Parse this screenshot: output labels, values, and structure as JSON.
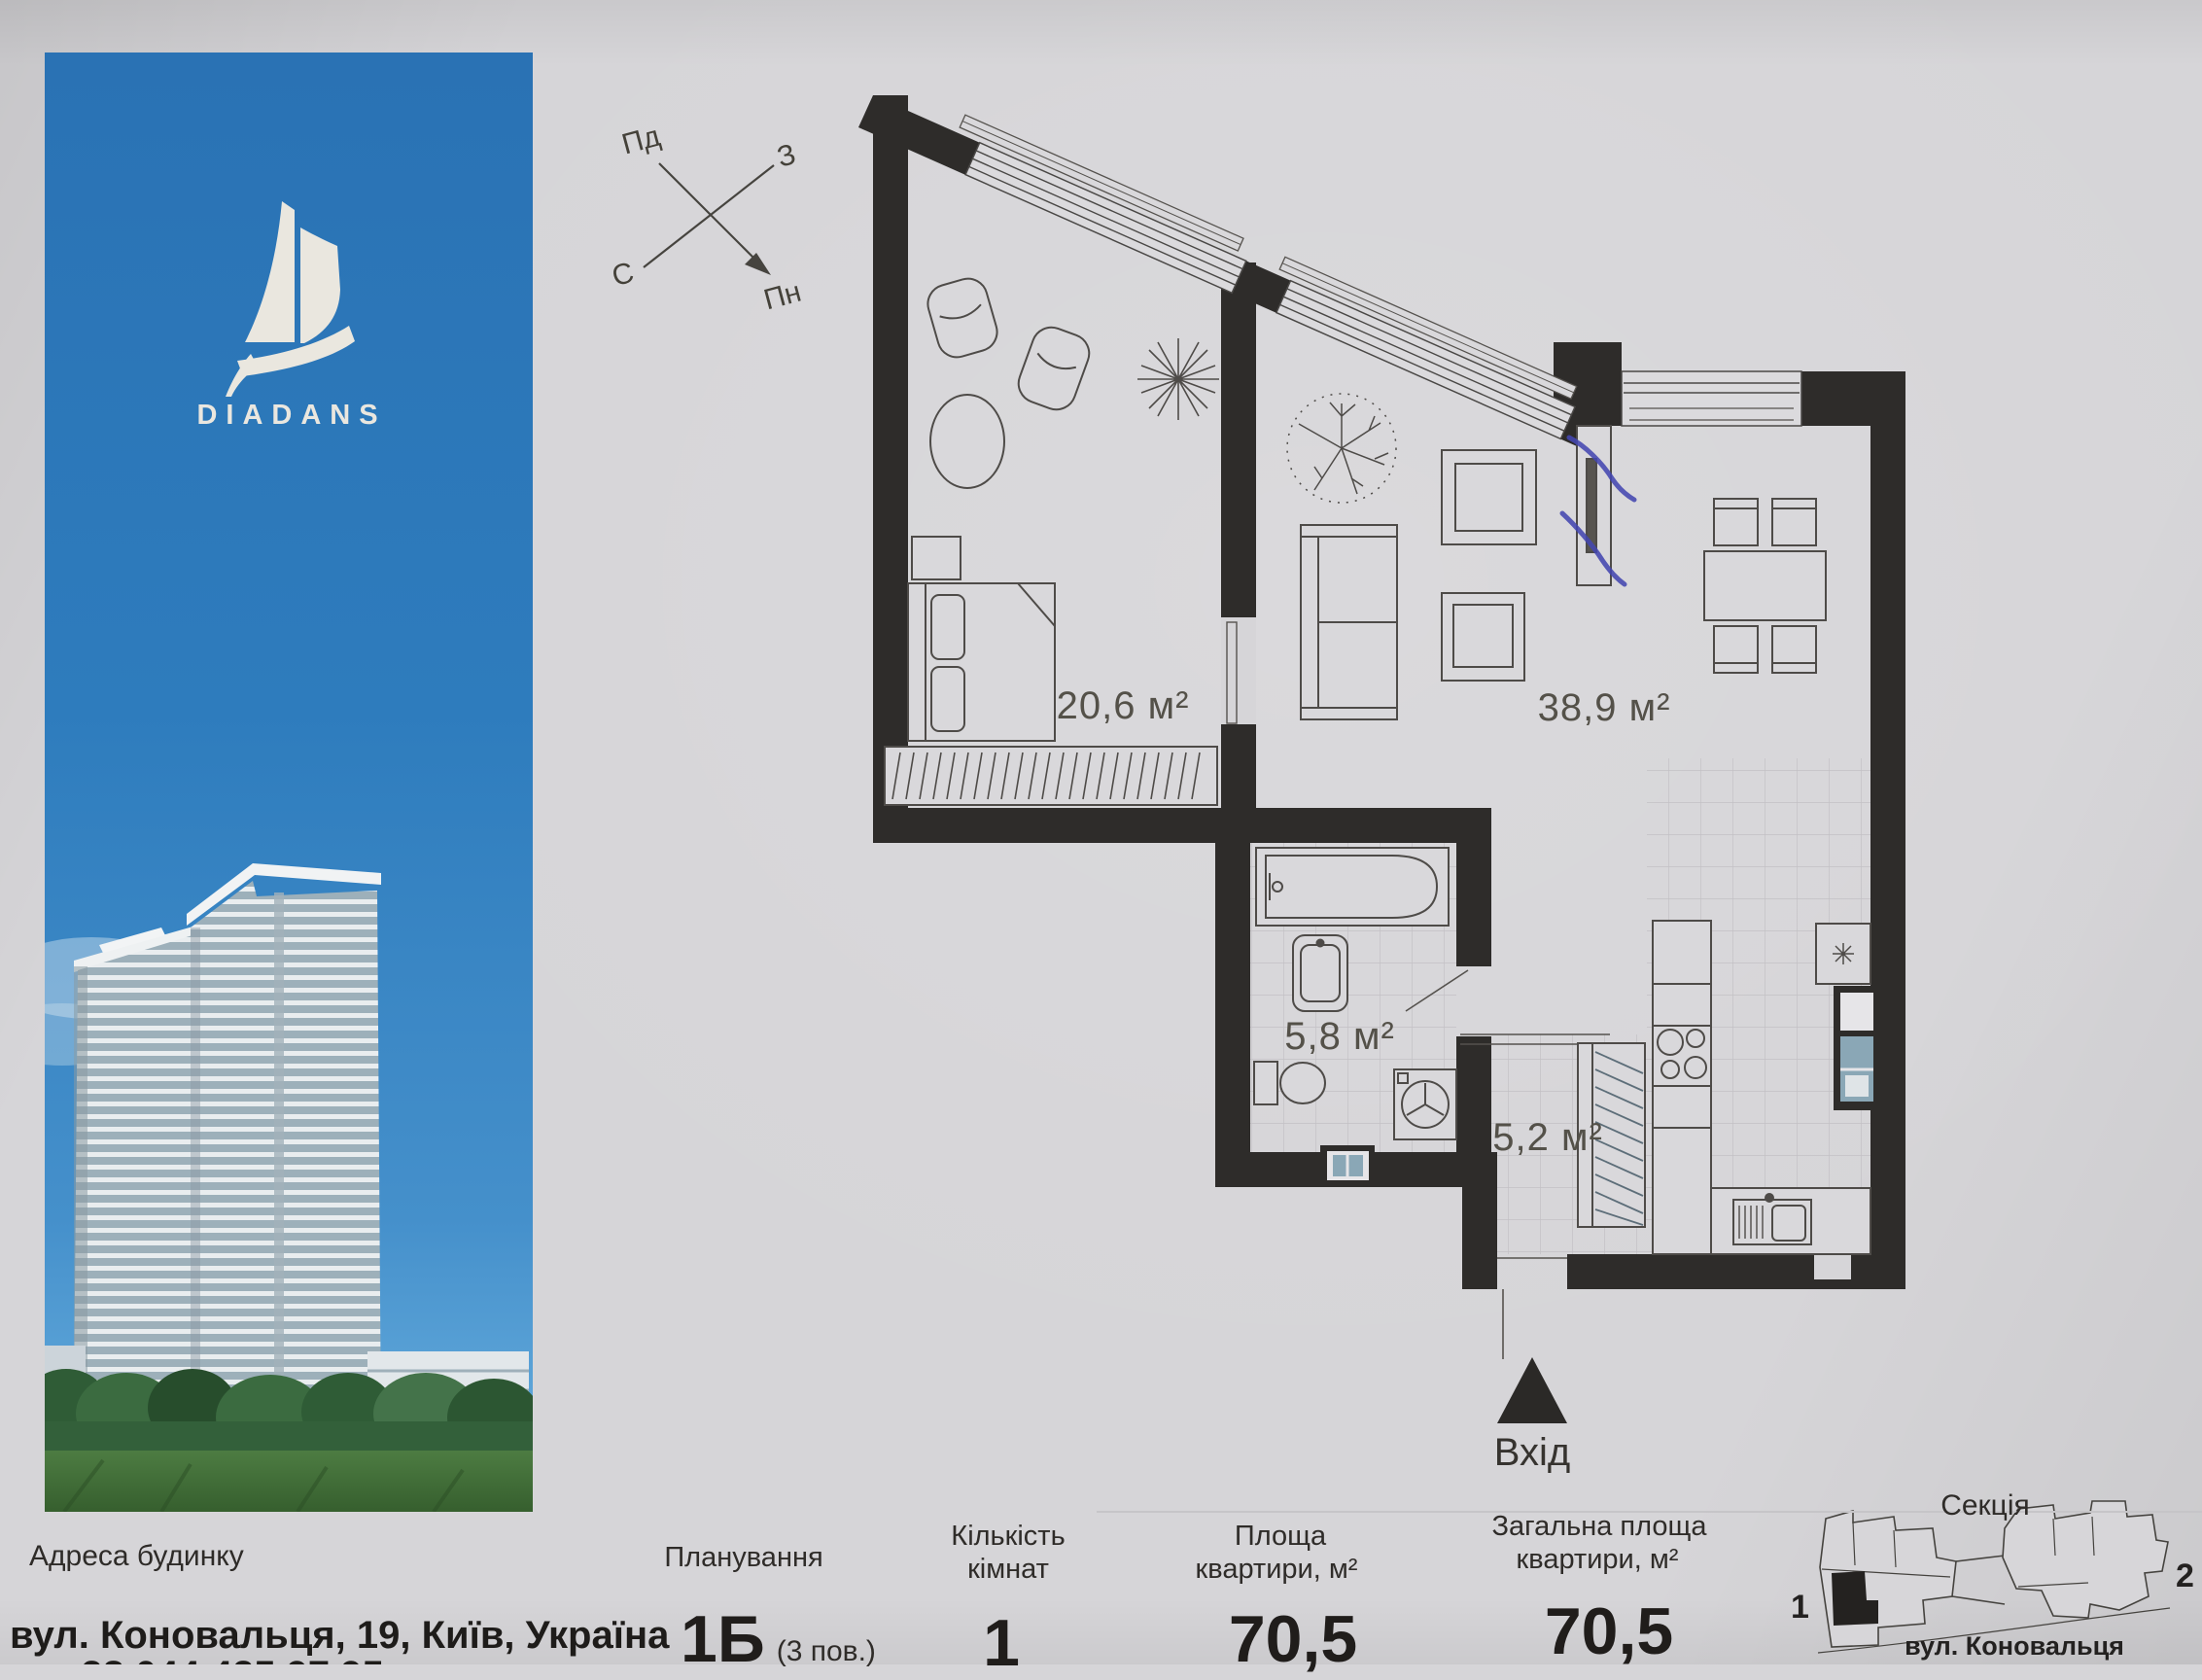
{
  "brand": {
    "name": "DIADANS"
  },
  "compass": {
    "top_left": "Пд",
    "top_right": "З",
    "bottom_left": "С",
    "bottom_right": "Пн"
  },
  "floor_plan": {
    "bedroom_area": "20,6 м²",
    "living_area": "38,9 м²",
    "bathroom_area": "5,8 м²",
    "hallway_area": "5,2 м²",
    "entrance_label": "Вхід"
  },
  "footer": {
    "address_label": "Адреса будинку",
    "address_value": "вул. Коновальця, 19, Київ, Україна",
    "address_phone_clipped": "+38 044 425 97 95",
    "planning_label": "Планування",
    "planning_value": "1Б",
    "planning_note": "(3 пов.)",
    "rooms_label_line1": "Кількість",
    "rooms_label_line2": "кімнат",
    "rooms_value": "1",
    "area_label_line1": "Площа",
    "area_label_line2": "квартири, м²",
    "area_value": "70,5",
    "total_label_line1": "Загальна площа",
    "total_label_line2": "квартири, м²",
    "total_value": "70,5",
    "section_label": "Секція",
    "section_1": "1",
    "section_2": "2",
    "section_street": "вул. Коновальця"
  },
  "colors": {
    "banner_blue": "#2c77b8",
    "paper": "#d6d5d8",
    "wall_black": "#2e2c2a",
    "pen_blue": "#4447b0"
  }
}
